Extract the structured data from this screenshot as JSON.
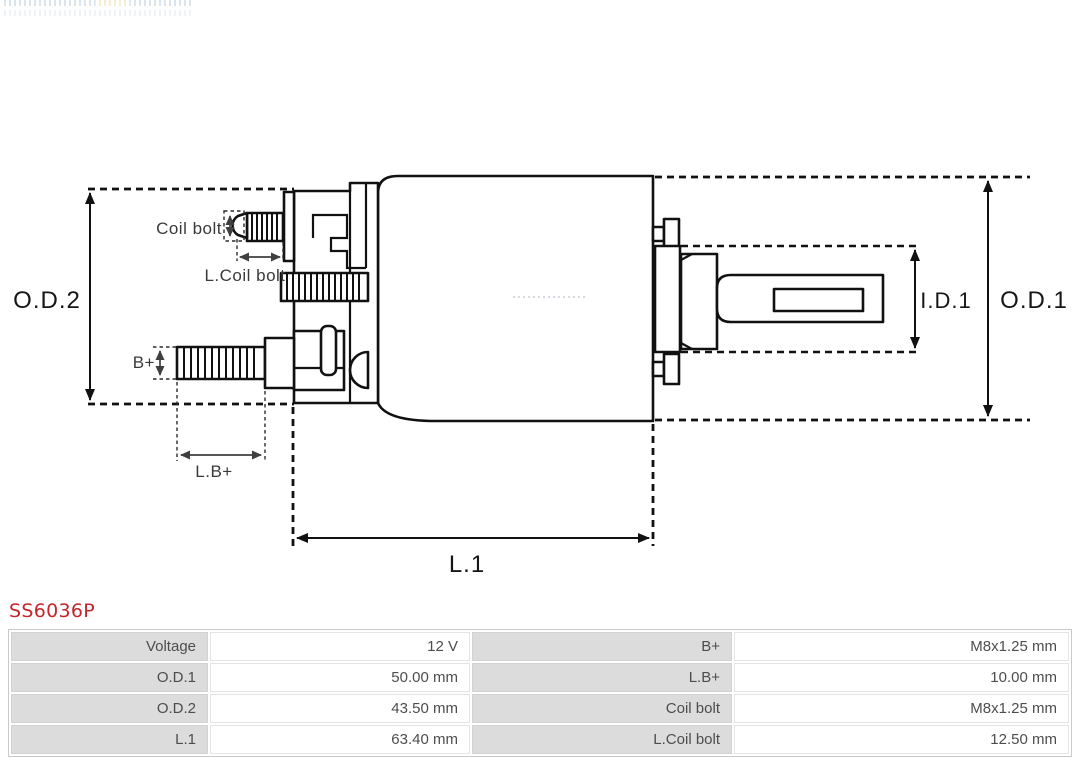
{
  "header": {
    "part_number": "SS6036P"
  },
  "colors": {
    "accent_red": "#c4262b",
    "diagram_line": "#111111",
    "dimension_line": "#3f3f3f",
    "table_label_bg": "#dcdcdc",
    "table_border": "#c9c9c9"
  },
  "diagram": {
    "type": "solenoid-technical-drawing",
    "labels": {
      "od2": "O.D.2",
      "od1": "O.D.1",
      "id1": "I.D.1",
      "l1": "L.1",
      "coil_bolt": "Coil bolt",
      "l_coil_bolt": "L.Coil bolt",
      "b_plus": "B+",
      "l_b_plus": "L.B+"
    }
  },
  "spec_table": {
    "rows": [
      {
        "c1_label": "Voltage",
        "c1_value": "12 V",
        "c2_label": "B+",
        "c2_value": "M8x1.25 mm"
      },
      {
        "c1_label": "O.D.1",
        "c1_value": "50.00 mm",
        "c2_label": "L.B+",
        "c2_value": "10.00 mm"
      },
      {
        "c1_label": "O.D.2",
        "c1_value": "43.50 mm",
        "c2_label": "Coil bolt",
        "c2_value": "M8x1.25 mm"
      },
      {
        "c1_label": "L.1",
        "c1_value": "63.40 mm",
        "c2_label": "L.Coil bolt",
        "c2_value": "12.50 mm"
      }
    ]
  }
}
